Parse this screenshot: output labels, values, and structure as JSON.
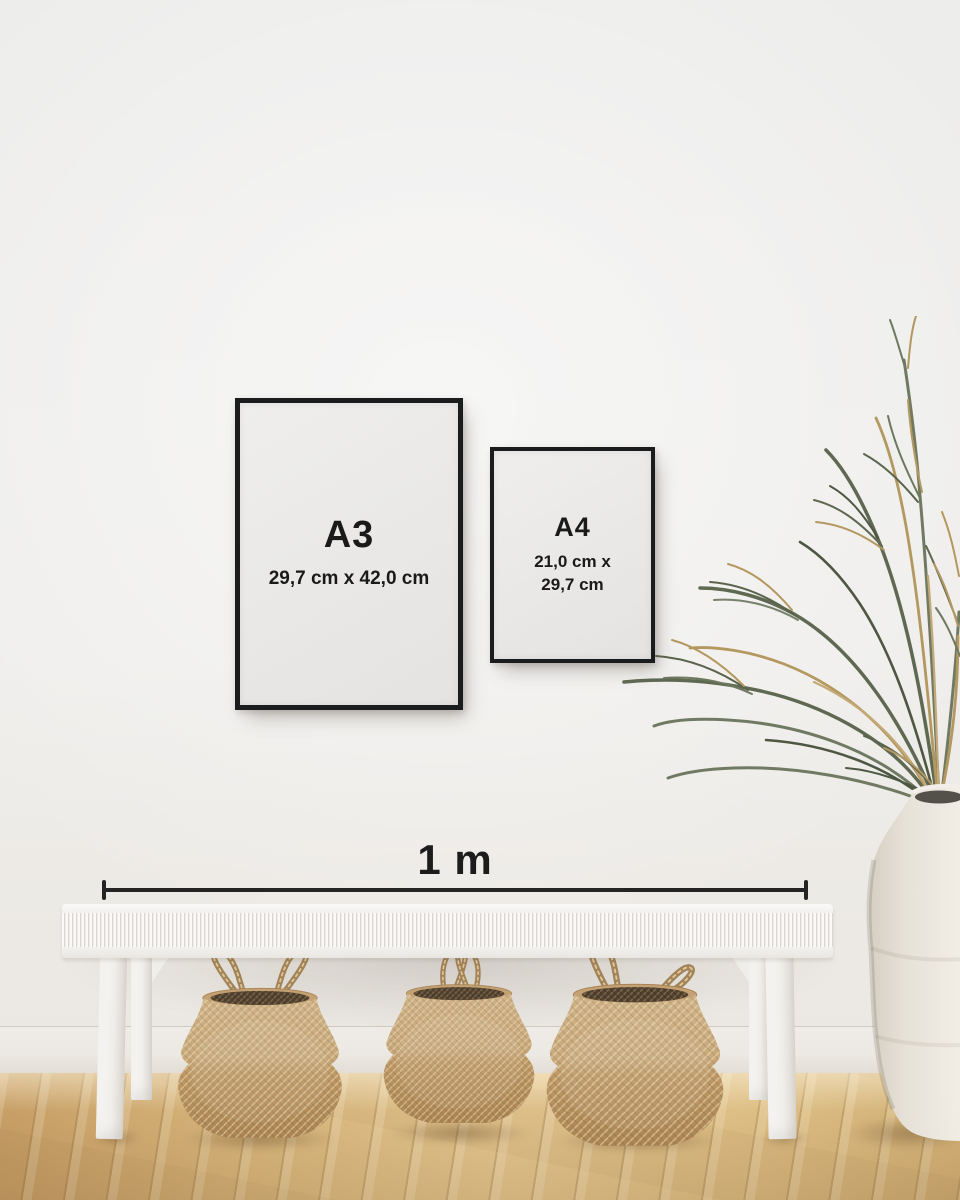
{
  "frames": {
    "a3": {
      "label": "A3",
      "size": "29,7 cm x 42,0 cm"
    },
    "a4": {
      "label": "A4",
      "size_line1": "21,0 cm x",
      "size_line2": "29,7 cm"
    }
  },
  "scale": {
    "label": "1 m"
  },
  "room": {
    "basket_count": 3
  },
  "colors": {
    "wall": "#efeeed",
    "baseboard": "#ece8e2",
    "frame_border": "#1b1c1e",
    "frame_paper": "#eae9e7",
    "text": "#1a1a1a",
    "scale_line": "#242424",
    "bench_white": "#f5f4f1",
    "basket_light": "#c8a97b",
    "basket_dark": "#b28c58",
    "floor_light": "#e2c48d",
    "floor_dark": "#c79f66",
    "plant_green": "#66705a",
    "plant_dried": "#b3985f",
    "vase_cream": "#ebe6de"
  }
}
